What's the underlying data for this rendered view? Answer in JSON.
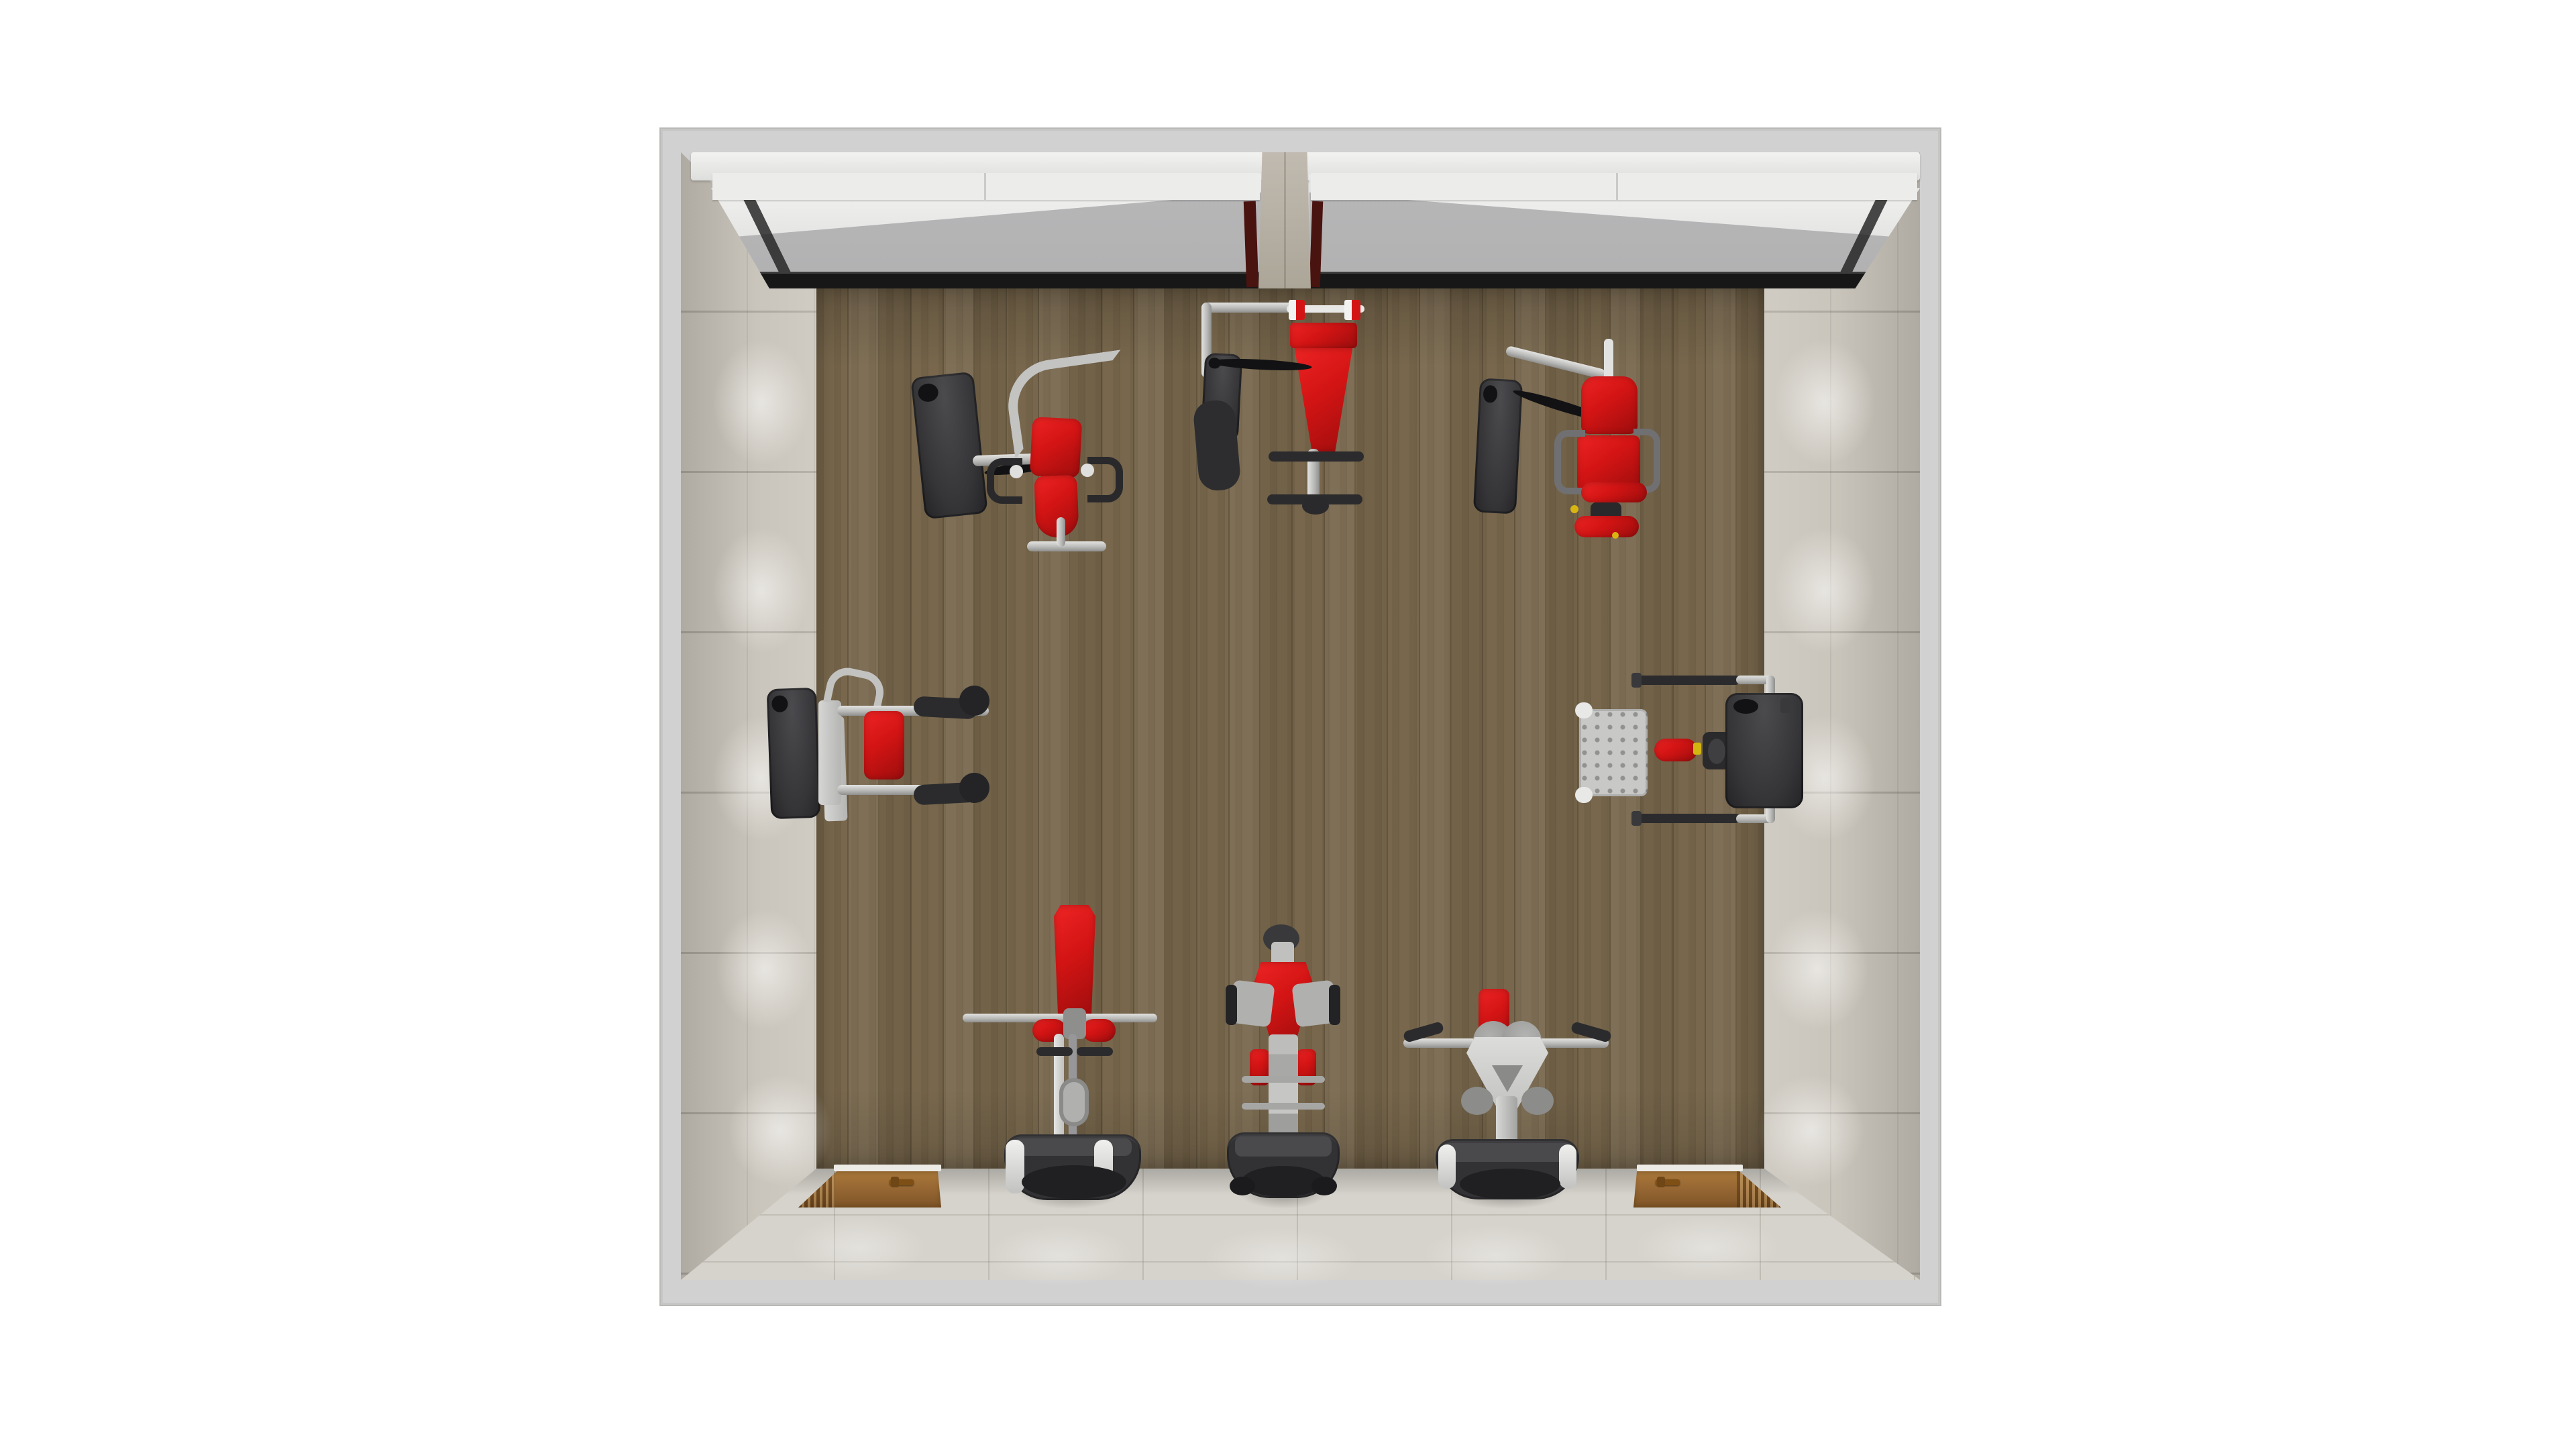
{
  "scene": {
    "title": "Gym room - top view 3D render",
    "type": "interior architectural visualization, top-down view",
    "background": "white"
  },
  "palette": {
    "page-bg": "#ffffff",
    "frame-gray": "#d1d1d1",
    "frame-edge": "#b9b9b6",
    "valance-white": "#f2f2f1",
    "blind-white": "#ececeb",
    "glass-gray": "#b1b1b2",
    "window-frame-dark": "#171717",
    "column-concrete": "#c0bab0",
    "maroon-jamb": "#49130f",
    "wall-tile": "#c7c2b8",
    "floor-tile": "#d6d3cc",
    "wood-floor": "#77674d",
    "door-wood": "#9a6a35",
    "door-handle": "#7e5016",
    "machine-red": "#d31414",
    "machine-red-dark": "#9c0d0d",
    "steel": "#b9b9b7",
    "steel-dark": "#8f8f8d",
    "charcoal": "#353538",
    "charcoal-dark": "#202022"
  },
  "room": {
    "floor": {
      "material": "wood plank flooring",
      "area": "center of room"
    },
    "walls": {
      "left": "beige tiled wall with wall-washer light pools",
      "right": "beige tiled wall with wall-washer light pools",
      "bottom": "beige tiled wall with two wooden doors",
      "top": "window wall with two large gray windows"
    },
    "windows": {
      "count": 2,
      "glass": "gray",
      "blinds": "white roller blinds, partially lowered",
      "separator": "concrete column",
      "frame": "dark metal"
    },
    "doors": [
      {
        "id": "door-left",
        "position": "bottom wall, left side",
        "material": "wood",
        "handle": "bronze lever handle"
      },
      {
        "id": "door-right",
        "position": "bottom wall, right side",
        "material": "wood",
        "handle": "bronze lever handle"
      }
    ],
    "lighting": "recessed wall-washer light pools along side and bottom walls"
  },
  "equipment": [
    {
      "id": "m1",
      "name": "Seated row machine",
      "location": "top-left",
      "pads": "red",
      "frame": "silver steel",
      "weight_stack": "dark gray"
    },
    {
      "id": "m2",
      "name": "Weight bench with barbell rack",
      "location": "top-center",
      "pads": "red",
      "frame": "silver steel",
      "weight_stack": "dark gray"
    },
    {
      "id": "m3",
      "name": "Leg extension machine",
      "location": "top-right",
      "pads": "red",
      "frame": "silver steel",
      "weight_stack": "dark gray"
    },
    {
      "id": "m4",
      "name": "Seated chest press machine",
      "location": "middle-left",
      "pads": "red",
      "frame": "silver steel",
      "weight_stack": "dark gray"
    },
    {
      "id": "m5",
      "name": "Seated calf press machine with foot platform",
      "location": "middle-right",
      "pads": "red",
      "frame": "silver steel",
      "weight_stack": "dark gray"
    },
    {
      "id": "m6",
      "name": "Standing calf raise machine",
      "location": "bottom-left",
      "pads": "red",
      "frame": "silver steel",
      "weight_stack": "dark gray"
    },
    {
      "id": "m7",
      "name": "V-squat machine",
      "location": "bottom-center",
      "pads": "red",
      "frame": "silver steel",
      "weight_stack": "dark gray"
    },
    {
      "id": "m8",
      "name": "Lateral raise machine",
      "location": "bottom-right",
      "pads": "red",
      "frame": "silver steel",
      "weight_stack": "dark gray"
    }
  ]
}
